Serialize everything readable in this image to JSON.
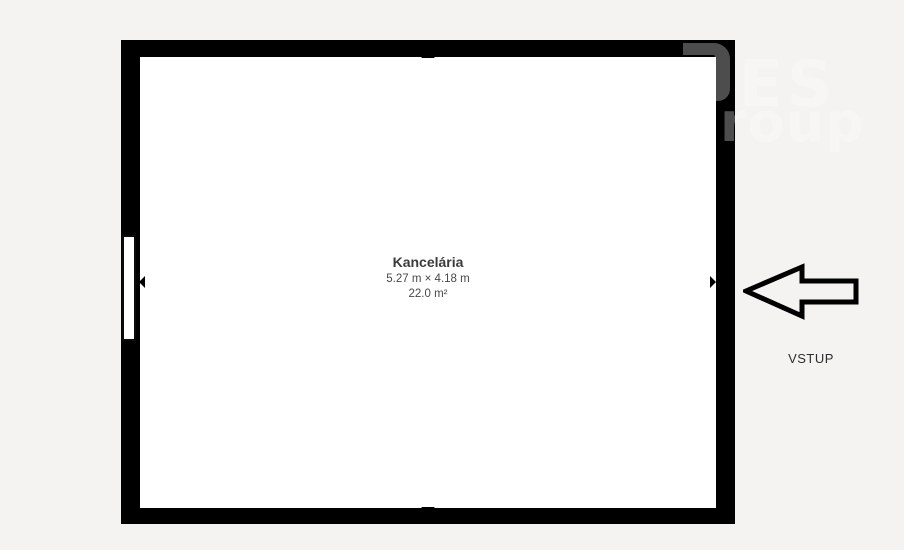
{
  "colors": {
    "background": "#f4f3f1",
    "wall": "#000000",
    "floor": "#ffffff",
    "label_title": "#3b3b3b",
    "label_secondary": "#494949",
    "arrow_outline": "#000000"
  },
  "floor_plan": {
    "room": {
      "name": "Kancelária",
      "dimensions": "5.27 m × 4.18 m",
      "area": "22.0 m²"
    }
  },
  "entrance": {
    "label": "VSTUP",
    "arrow_direction": "left"
  },
  "watermark": {
    "line1": "ES",
    "line2": "roup"
  }
}
